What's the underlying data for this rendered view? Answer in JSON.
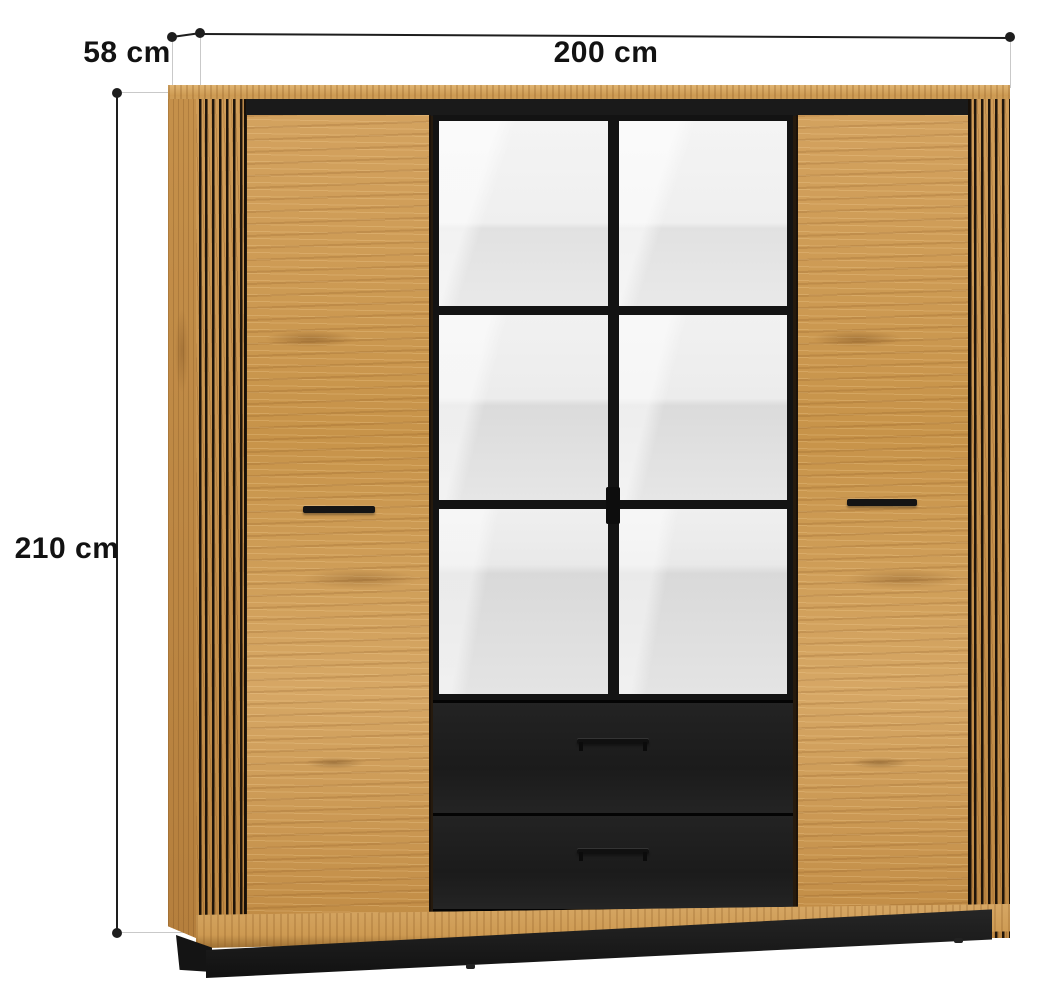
{
  "annotations": {
    "width": {
      "label": "200 cm"
    },
    "depth": {
      "label": "58 cm"
    },
    "height": {
      "label": "210 cm"
    }
  },
  "colors": {
    "background": "#ffffff",
    "wood_base": "#cd9a55",
    "wood_dark": "#bd8844",
    "accent_black": "#1a1a1a",
    "mirror_light": "#ededed",
    "dim_line": "#1e1e1e",
    "ext_line": "#c9c9c9",
    "text": "#121212"
  }
}
